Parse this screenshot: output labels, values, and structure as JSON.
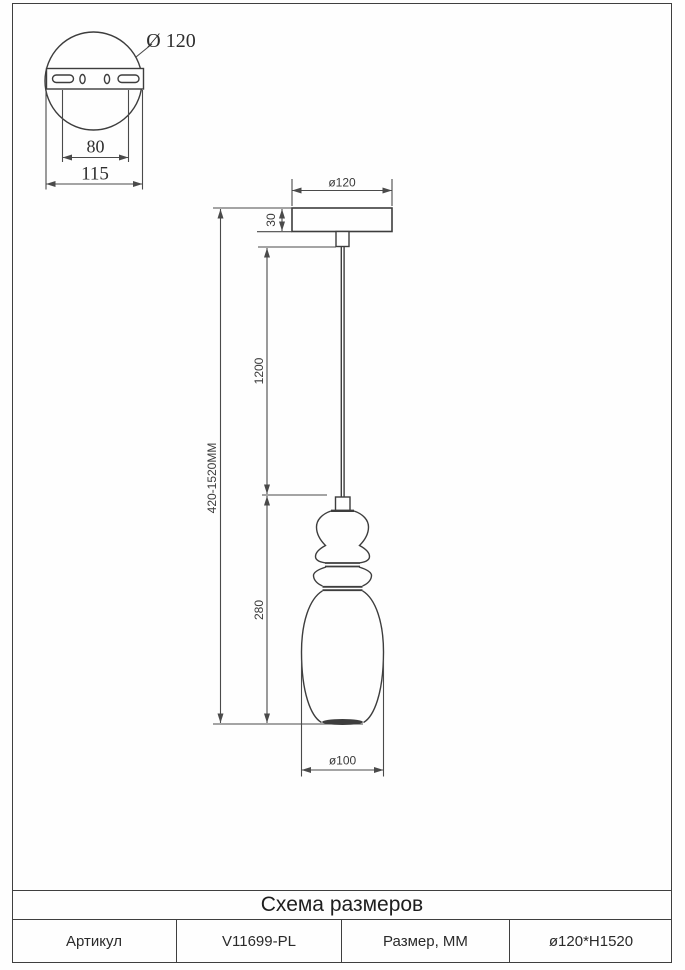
{
  "mount_detail": {
    "diameter_label": "Ø 120",
    "hole_spacing_label": "80",
    "plate_width_label": "115"
  },
  "pendant": {
    "canopy_diameter_label": "ø120",
    "canopy_height_label": "30",
    "suspension_length_label": "1200",
    "overall_height_label": "420-1520MM",
    "shade_height_label": "280",
    "shade_diameter_label": "ø100"
  },
  "table": {
    "title": "Схема размеров",
    "row": [
      {
        "label": "Артикул"
      },
      {
        "label": "V11699-PL"
      },
      {
        "label": "Размер, ММ"
      },
      {
        "label": "ø120*H1520"
      }
    ]
  }
}
